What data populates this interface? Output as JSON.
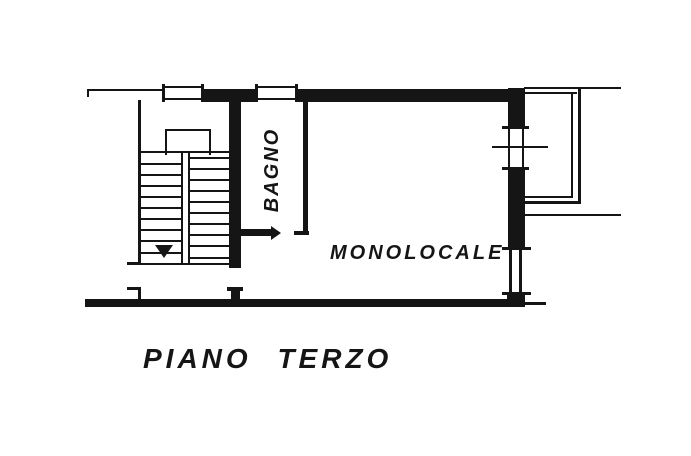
{
  "colors": {
    "ink": "#151515",
    "paper": "#ffffff"
  },
  "plan": {
    "caption": "PIANO TERZO",
    "rooms": {
      "studio": {
        "label": "MONOLOCALE"
      },
      "bathroom": {
        "label": "BAGNO"
      }
    }
  }
}
